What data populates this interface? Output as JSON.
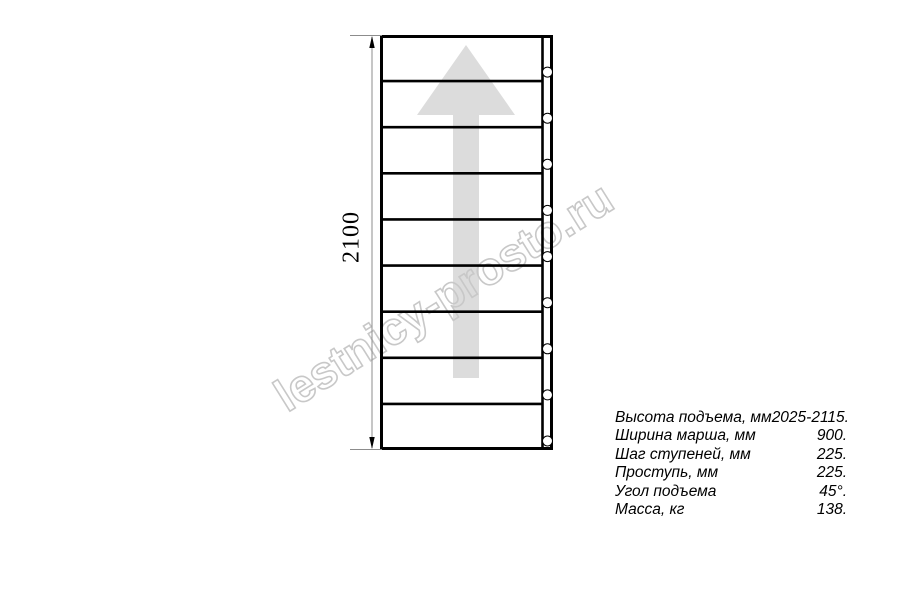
{
  "watermark": {
    "text": "lestnicy-prosto.ru"
  },
  "diagram": {
    "title": "staircase-plan-view",
    "dimension_label": "2100",
    "step_count": 9,
    "hole_count": 9,
    "direction": "up"
  },
  "spec": {
    "rows": [
      {
        "label": "Высота подъема, мм",
        "value": "2025-2115."
      },
      {
        "label": "Ширина марша, мм",
        "value": "900."
      },
      {
        "label": "Шаг ступеней, мм",
        "value": "225."
      },
      {
        "label": "Проступь, мм",
        "value": "225."
      },
      {
        "label": "Угол подъема",
        "value": "45°."
      },
      {
        "label": "Масса, кг",
        "value": "138."
      }
    ]
  },
  "colors": {
    "line": "#000000",
    "arrow_fill": "#dcdcdc",
    "dimension_line": "#8c8c8c",
    "watermark_stroke": "#c8c8c8",
    "hole_fill": "#ffffff"
  }
}
